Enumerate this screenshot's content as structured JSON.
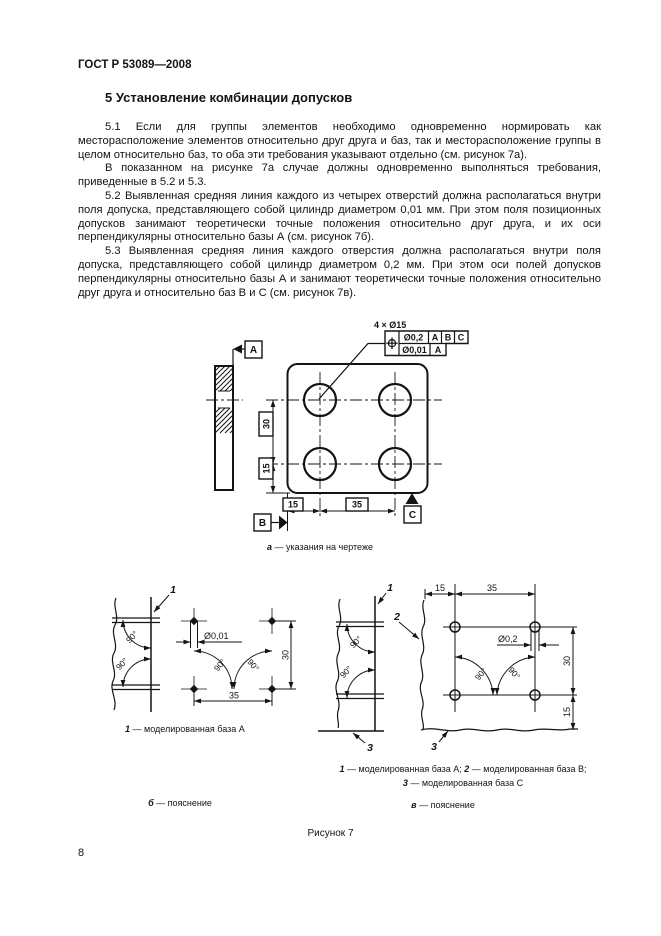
{
  "page": {
    "header": "ГОСТ Р 53089—2008",
    "page_number": "8"
  },
  "section": {
    "heading": "5  Установление комбинации допусков",
    "paragraphs": [
      "5.1  Если для группы элементов необходимо одновременно нормировать как месторасположение элементов относительно друг друга и баз, так и месторасположение группы в целом относительно баз, то оба эти требования указывают отдельно (см. рисунок 7а).",
      "В показанном на рисунке 7а случае должны одновременно выполняться требования, приведенные в 5.2 и 5.3.",
      "5.2  Выявленная средняя линия каждого из четырех отверстий должна располагаться внутри поля допуска, представляющего собой цилиндр диаметром 0,01 мм. При этом поля позиционных допусков занимают теоретически точные положения относительно друг друга, и их оси перпендикулярны относительно базы А (см. рисунок 7б).",
      "5.3  Выявленная средняя линия каждого отверстия должна располагаться внутри поля допуска, представляющего собой цилиндр диаметром 0,2 мм. При этом оси полей допусков перпендикулярны относительно базы А и занимают теоретически точные положения относительно друг друга и относительно баз В и С (см. рисунок 7в)."
    ]
  },
  "figure": {
    "title": "Рисунок 7",
    "part_a": {
      "label_holes": "4 × Ø15",
      "fcf_row1": {
        "tol": "Ø0,2",
        "d1": "A",
        "d2": "B",
        "d3": "C"
      },
      "fcf_row2": {
        "tol": "Ø0,01",
        "d1": "A"
      },
      "datum_a": "A",
      "datum_b": "B",
      "datum_c": "C",
      "dim_v30": "30",
      "dim_v15": "15",
      "dim_h15": "15",
      "dim_h35": "35",
      "cap_letter": "а",
      "cap_text": " — указания на чертеже"
    },
    "part_b": {
      "ref_1": "1",
      "zone_dia": "Ø0,01",
      "dim_h35": "35",
      "dim_v30": "30",
      "angle_1": "90°",
      "angle_2": "90°",
      "angle_3": "90°",
      "angle_4": "90°",
      "legend_num": "1",
      "legend_text": " — моделированная база А",
      "cap_letter": "б",
      "cap_text": " — пояснение"
    },
    "part_v": {
      "ref_1": "1",
      "ref_2": "2",
      "ref_3_left": "3",
      "ref_3_right": "3",
      "zone_dia": "Ø0,2",
      "dim_top15": "15",
      "dim_top35": "35",
      "dim_r30": "30",
      "dim_r15": "15",
      "angle_1": "90°",
      "angle_2": "90°",
      "angle_3": "90°",
      "angle_4": "90°",
      "legend_n1": "1",
      "legend_t1": " — моделированная база А; ",
      "legend_n2": "2",
      "legend_t2": " — моделированная база В;",
      "legend_n3": "3",
      "legend_t3": " — моделированная база С",
      "cap_letter": "в",
      "cap_text": " — пояснение"
    }
  }
}
